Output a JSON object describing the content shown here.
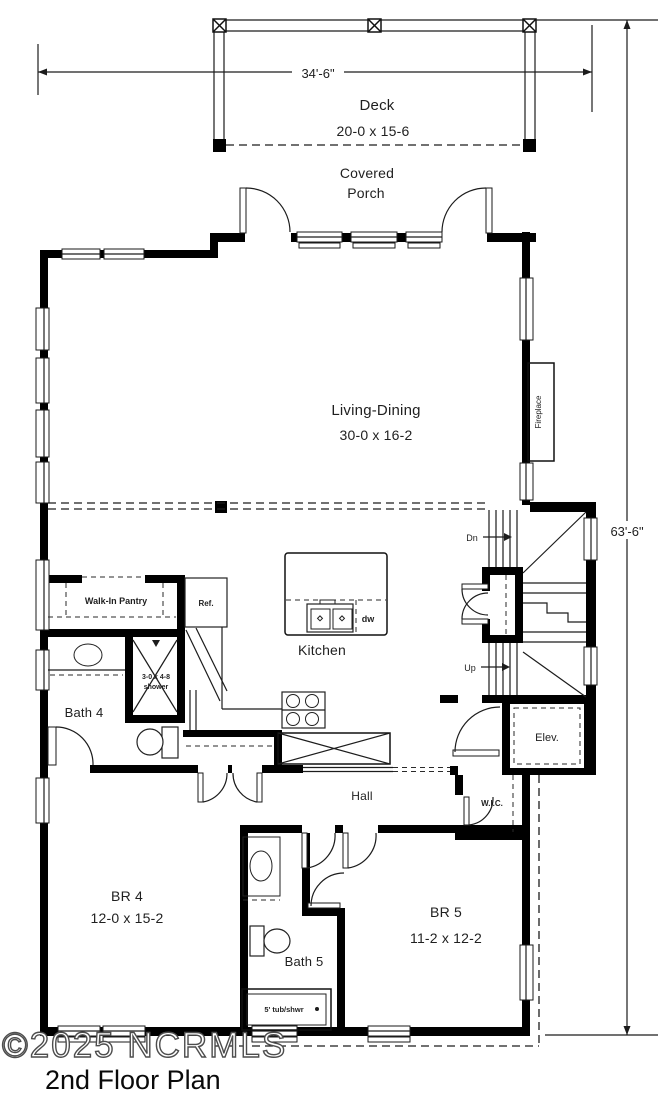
{
  "meta": {
    "title": "2nd Floor Plan",
    "watermark": "©2025 NCRMLS"
  },
  "dimensions": {
    "width_top": "34'-6\"",
    "height_right": "63'-6\""
  },
  "rooms": {
    "deck": {
      "name": "Deck",
      "size": "20-0 x 15-6"
    },
    "covered_porch": {
      "line1": "Covered",
      "line2": "Porch"
    },
    "living_dining": {
      "name": "Living-Dining",
      "size": "30-0 x 16-2"
    },
    "kitchen": {
      "name": "Kitchen"
    },
    "walk_in_pantry": {
      "name": "Walk-In Pantry"
    },
    "bath4": {
      "name": "Bath 4"
    },
    "bath5": {
      "name": "Bath 5"
    },
    "hall": {
      "name": "Hall"
    },
    "wic": {
      "name": "W.I.C."
    },
    "br4": {
      "name": "BR 4",
      "size": "12-0 x 15-2"
    },
    "br5": {
      "name": "BR 5",
      "size": "11-2 x 12-2"
    },
    "elevator": {
      "name": "Elev."
    },
    "fireplace": {
      "name": "Fireplace"
    }
  },
  "fixtures": {
    "refrigerator": "Ref.",
    "dishwasher": "dw",
    "shower_line1": "3-0 x 4-8",
    "shower_line2": "shower",
    "tub": "5' tub/shwr"
  },
  "stairs": {
    "down": "Dn",
    "up": "Up"
  },
  "colors": {
    "wall": "#000000",
    "line": "#1c1c1c",
    "text": "#1f1f1f"
  }
}
